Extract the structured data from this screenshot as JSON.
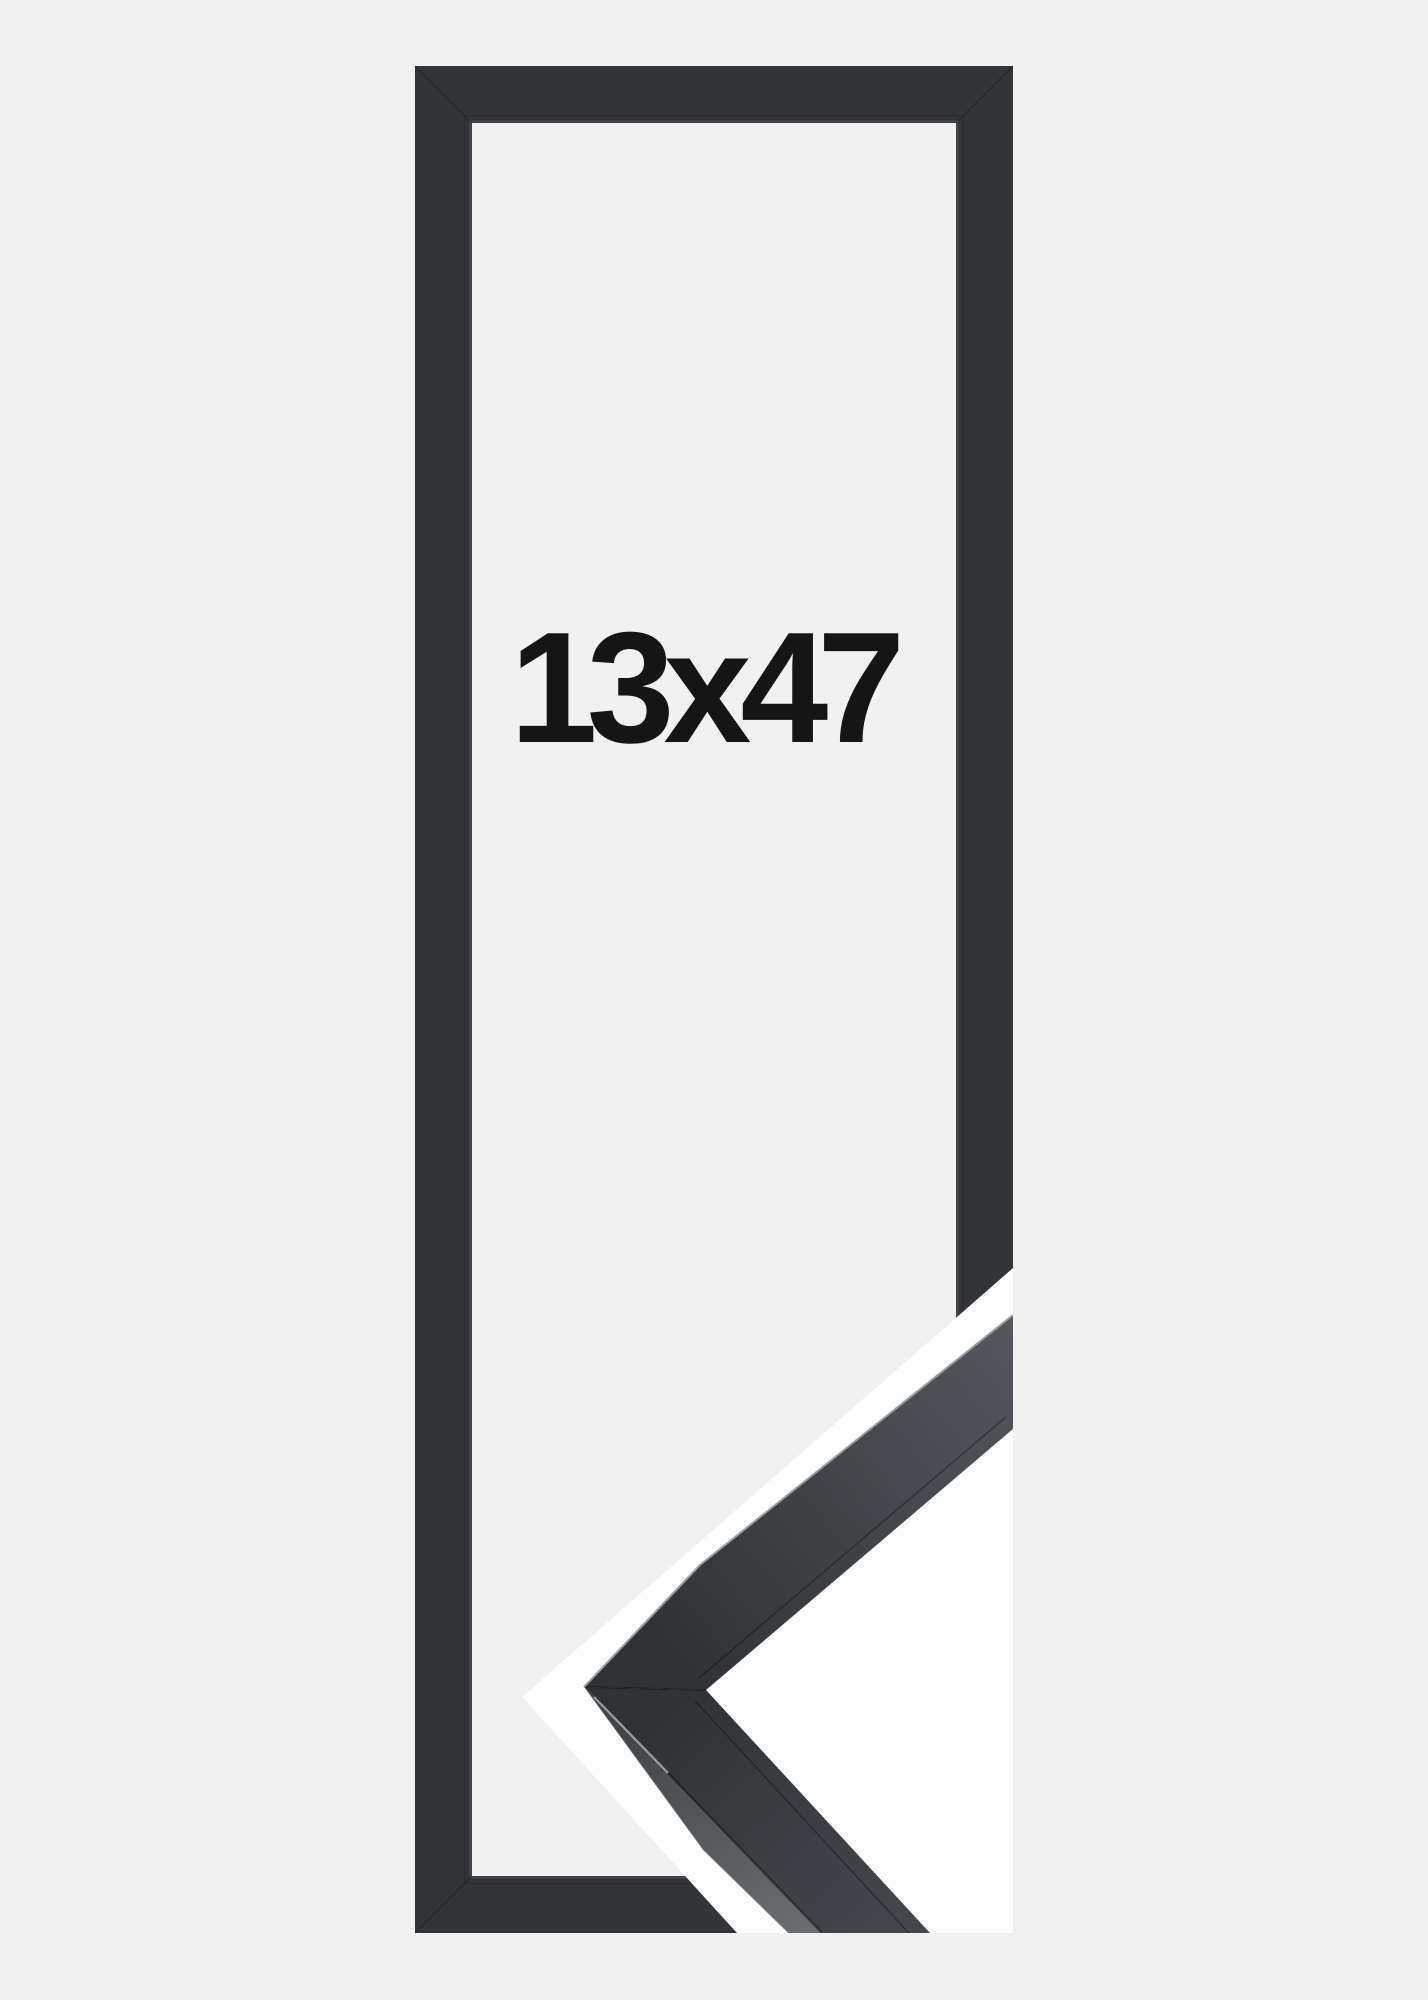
{
  "background_color": "#f1f1f2",
  "product": {
    "size_label": "13x47",
    "colors": {
      "frame": "#323437",
      "backdrop": "#fdfdfd",
      "label": "#151515",
      "moulding_face_dark": "#2f3134",
      "moulding_face_mid": "#43474b",
      "moulding_face_light": "#53575b",
      "moulding_side_dark": "#3d4043",
      "moulding_side_light": "#6a6e71",
      "edge_highlight": "#979da1"
    }
  }
}
